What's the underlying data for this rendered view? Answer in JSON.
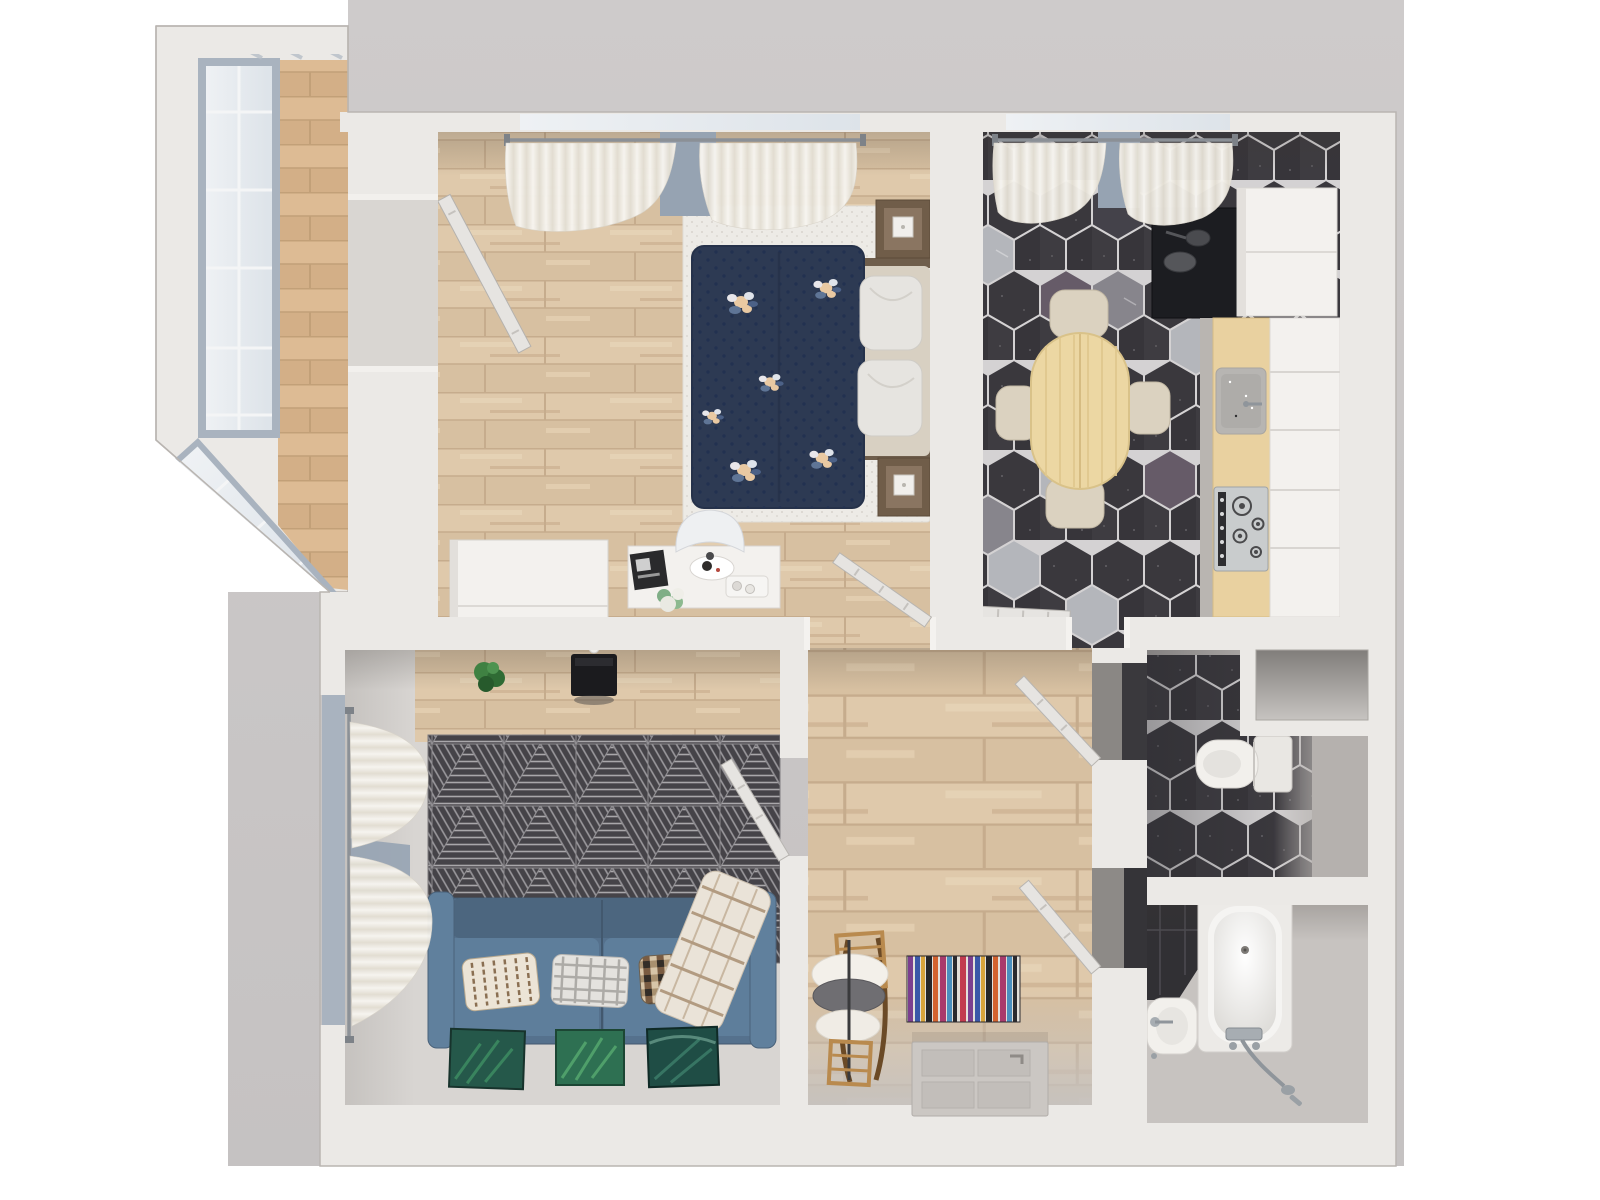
{
  "scene": {
    "type": "3d-floor-plan-top-view",
    "rooms": [
      {
        "name": "balcony",
        "objects": [
          "balcony-window",
          "balcony-floor"
        ]
      },
      {
        "name": "bedroom",
        "objects": [
          "bed",
          "duvet",
          "bed-pillows",
          "nightstand",
          "bedside-lamp",
          "white-rug",
          "wardrobe",
          "desk",
          "desk-chair",
          "balcony-door",
          "bedroom-door",
          "window-curtains",
          "wall-planters"
        ]
      },
      {
        "name": "kitchen",
        "objects": [
          "dining-table",
          "dining-chairs",
          "fridge",
          "dark-counter",
          "countertop",
          "kitchen-sink",
          "gas-hob",
          "cabinet-fronts",
          "hex-tile-floor",
          "kitchen-door",
          "window-curtains"
        ]
      },
      {
        "name": "living-room",
        "objects": [
          "sofa",
          "sofa-pillows",
          "plaid-blanket",
          "triangle-rug",
          "tv",
          "plant",
          "leaning-pictures",
          "side-window-curtains",
          "living-door"
        ]
      },
      {
        "name": "hallway",
        "objects": [
          "striped-rug",
          "rocking-toy",
          "entry-door",
          "toilet-door",
          "bathroom-door"
        ]
      },
      {
        "name": "toilet-room",
        "objects": [
          "toilet",
          "vent-niche",
          "hex-tile-floor"
        ]
      },
      {
        "name": "bathroom",
        "objects": [
          "bathtub",
          "bathroom-sink",
          "shower-fittings",
          "hex-tile-corner"
        ]
      }
    ]
  },
  "palette": {
    "page": "#ffffff",
    "backdrop": "#cecbcb",
    "backdrop_dark": "#c5c2c2",
    "wall": "#ebe9e6",
    "wall_edge": "#b9b5b1",
    "wood": "#dcc6a8",
    "wood_seam": "#c6ac8d",
    "balcony_wood": "#d9b68f",
    "glass": "#e8edf1",
    "glass_frame": "#a9b3bf",
    "window_glimpse": "#96a3b2",
    "hex_dark": "#3a383d",
    "hex_light": "#b4b6bb",
    "hex_mid": "#87858c",
    "hex_purple": "#665b68",
    "tile_gap": "#d4d2d3",
    "white_rug": "#edebe6",
    "duvet_navy": "#2d3a53",
    "flower_peach": "#e9c9a2",
    "bed_pillow": "#e6e4e0",
    "headboard": "#d8d0c2",
    "nightstand_wood": "#705d49",
    "furniture_white": "#f3f1ee",
    "rug_charcoal": "#454348",
    "rug_line": "#a9a7aa",
    "sofa_blue": "#55718d",
    "sofa_seat": "#5e7e9b",
    "sofa_back": "#4c667f",
    "pillow_stripe": "#8a6f52",
    "plaid": "#eae3d8",
    "picture_green": "#2e7052",
    "plant_green": "#2f6b34",
    "planter_green": "#1e6b4f",
    "table_wood": "#ecd7a3",
    "chair_beige": "#dbd2c0",
    "counter_wood": "#e9d1a0",
    "dark_counter": "#1c1d21",
    "steel": "#c9cccd",
    "chrome": "#8f959b",
    "fixture_white": "#f2f0ec",
    "door_leaf": "#e6e4e1",
    "entry_door": "#cbc7c3",
    "rug_stripe_red": "#c23a4e",
    "rug_stripe_purple": "#7c3f8f",
    "rug_stripe_blue": "#3a57a8",
    "rug_stripe_yellow": "#d9a43a",
    "toy_wood": "#b98a4e"
  }
}
